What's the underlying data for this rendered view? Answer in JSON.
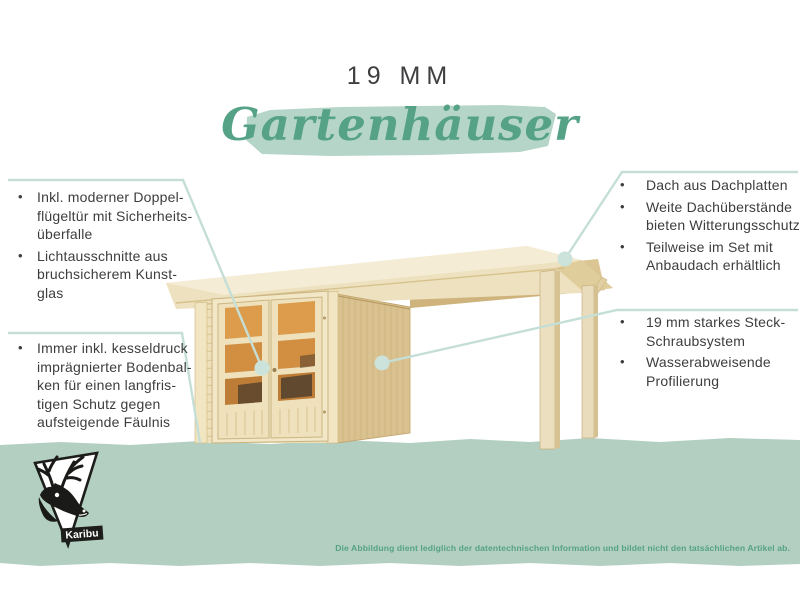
{
  "ui": {
    "bullet": "•"
  },
  "title": {
    "size_label": "19 MM",
    "script_word": "Gartenhäuser"
  },
  "callouts": {
    "left_top": {
      "items": [
        {
          "lines": [
            "Inkl. moderner Doppel-",
            "flügeltür mit Sicherheits-",
            "überfalle"
          ]
        },
        {
          "lines": [
            "Lichtausschnitte aus",
            "bruchsicherem Kunst-",
            "glas"
          ]
        }
      ]
    },
    "left_bottom": {
      "items": [
        {
          "lines": [
            "Immer inkl. kesseldruck",
            "imprägnierter Bodenbal-",
            "ken für einen langfris-",
            "tigen Schutz gegen",
            "aufsteigende Fäulnis"
          ]
        }
      ]
    },
    "right_top": {
      "items": [
        {
          "lines": [
            "Dach aus Dachplatten"
          ]
        },
        {
          "lines": [
            "Weite Dachüberstände",
            "bieten Witterungsschutz"
          ]
        },
        {
          "lines": [
            "Teilweise im Set mit",
            "Anbaudach erhältlich"
          ]
        }
      ]
    },
    "right_bottom": {
      "items": [
        {
          "lines": [
            "19 mm starkes Steck-",
            "Schraubsystem"
          ]
        },
        {
          "lines": [
            "Wasserabweisende",
            "Profilierung"
          ]
        }
      ]
    }
  },
  "footer": {
    "disclaimer": "Die Abbildung dient lediglich der datentechnischen Information und bildet nicht den tatsächlichen Artikel ab."
  },
  "logo": {
    "brand": "Karibu"
  },
  "colors": {
    "accent_green": "#55a286",
    "brush_green": "#b6d5c9",
    "band_green": "#b3cfc2",
    "leader_line": "#c5dfd6",
    "text_dark": "#3d3d3f"
  }
}
